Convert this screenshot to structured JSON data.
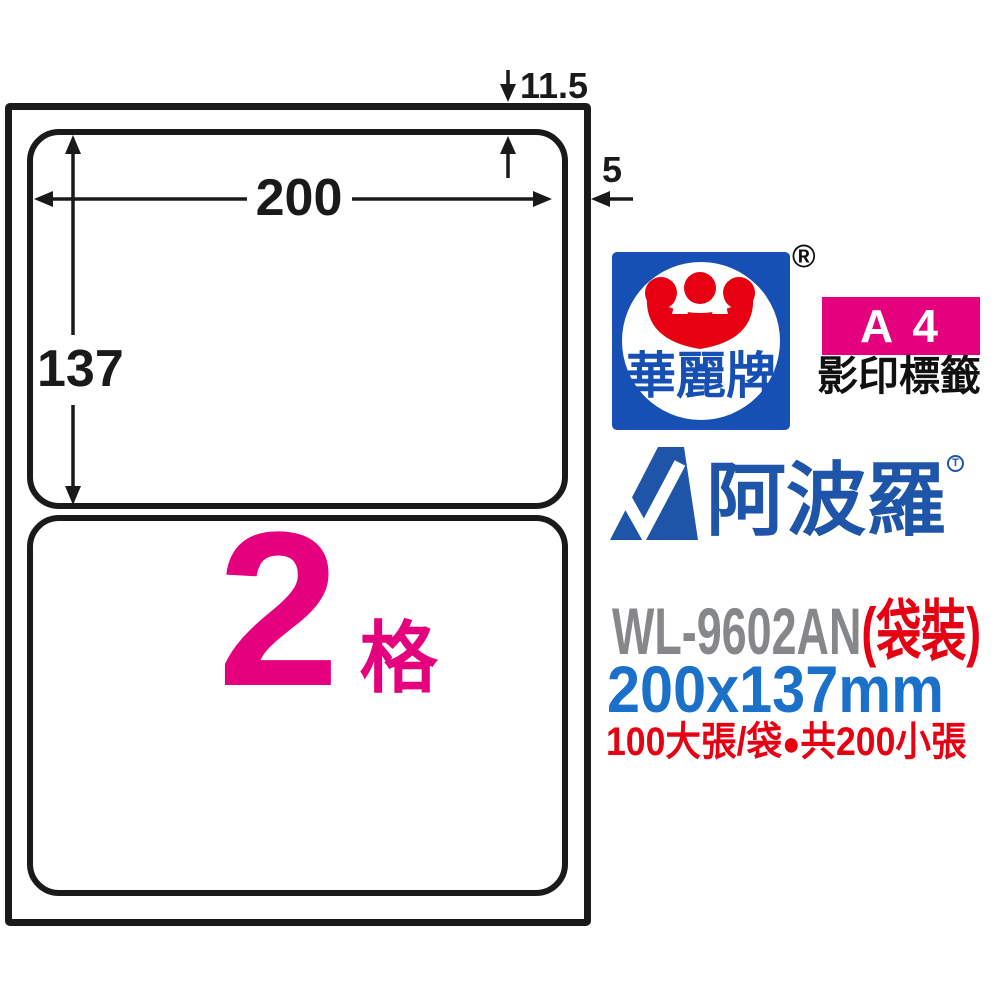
{
  "diagram": {
    "width_mm": "200",
    "height_mm": "137",
    "top_margin_mm": "11.5",
    "side_margin_mm": "5",
    "cell_count": "2",
    "cell_unit": "格"
  },
  "branding": {
    "brand_name": "華麗牌",
    "registered_mark": "®",
    "paper_size_badge": "A 4",
    "badge_subtitle": "影印標籤",
    "apollo_name": "阿波羅",
    "apollo_mark": "T"
  },
  "product": {
    "code": "WL-9602AN",
    "package_type": "(袋裝)",
    "label_size": "200x137mm",
    "qty_sheets": "100大張/袋",
    "bullet": "●",
    "qty_labels": "共200小張"
  },
  "colors": {
    "magenta": "#E5007E",
    "red": "#E60012",
    "brand_blue": "#1750B4",
    "apollo_blue": "#1E55A8",
    "size_blue": "#1B70C9",
    "code_gray": "#85878A",
    "line_black": "#1A1A1A"
  }
}
